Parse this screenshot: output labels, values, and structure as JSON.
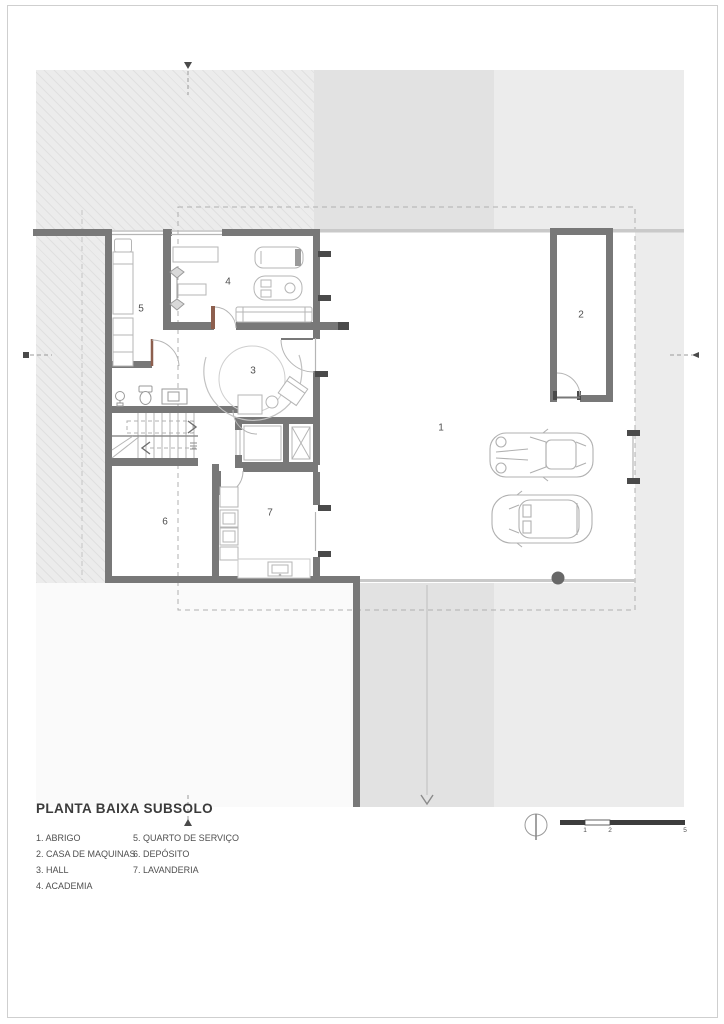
{
  "title_block": {
    "title": "PLANTA BAIXA SUBSOLO"
  },
  "legend": {
    "col1": [
      "1. ABRIGO",
      "2. CASA DE MAQUINAS",
      "3. HALL",
      "4. ACADEMIA"
    ],
    "col2": [
      "5. QUARTO DE SERVIÇO",
      "6. DEPÓSITO",
      "7. LAVANDERIA"
    ]
  },
  "rooms": [
    {
      "number": "1",
      "name": "ABRIGO"
    },
    {
      "number": "2",
      "name": "CASA DE MAQUINAS"
    },
    {
      "number": "3",
      "name": "HALL"
    },
    {
      "number": "4",
      "name": "ACADEMIA"
    },
    {
      "number": "5",
      "name": "QUARTO DE SERVIÇO"
    },
    {
      "number": "6",
      "name": "DEPÓSITO"
    },
    {
      "number": "7",
      "name": "LAVANDERIA"
    }
  ],
  "scale_bar": {
    "tick_labels": [
      "1",
      "2",
      "5"
    ]
  },
  "icons": {
    "north_indicator": "compass-circle-with-needle"
  },
  "colors": {
    "wall": "#787878",
    "wall_dark": "#4a4a4a",
    "terrain_light": "#ececec",
    "terrain_dark": "#e2e2e2",
    "door_leaf": "#8d5f4e",
    "driveway_dot": "#686868"
  }
}
